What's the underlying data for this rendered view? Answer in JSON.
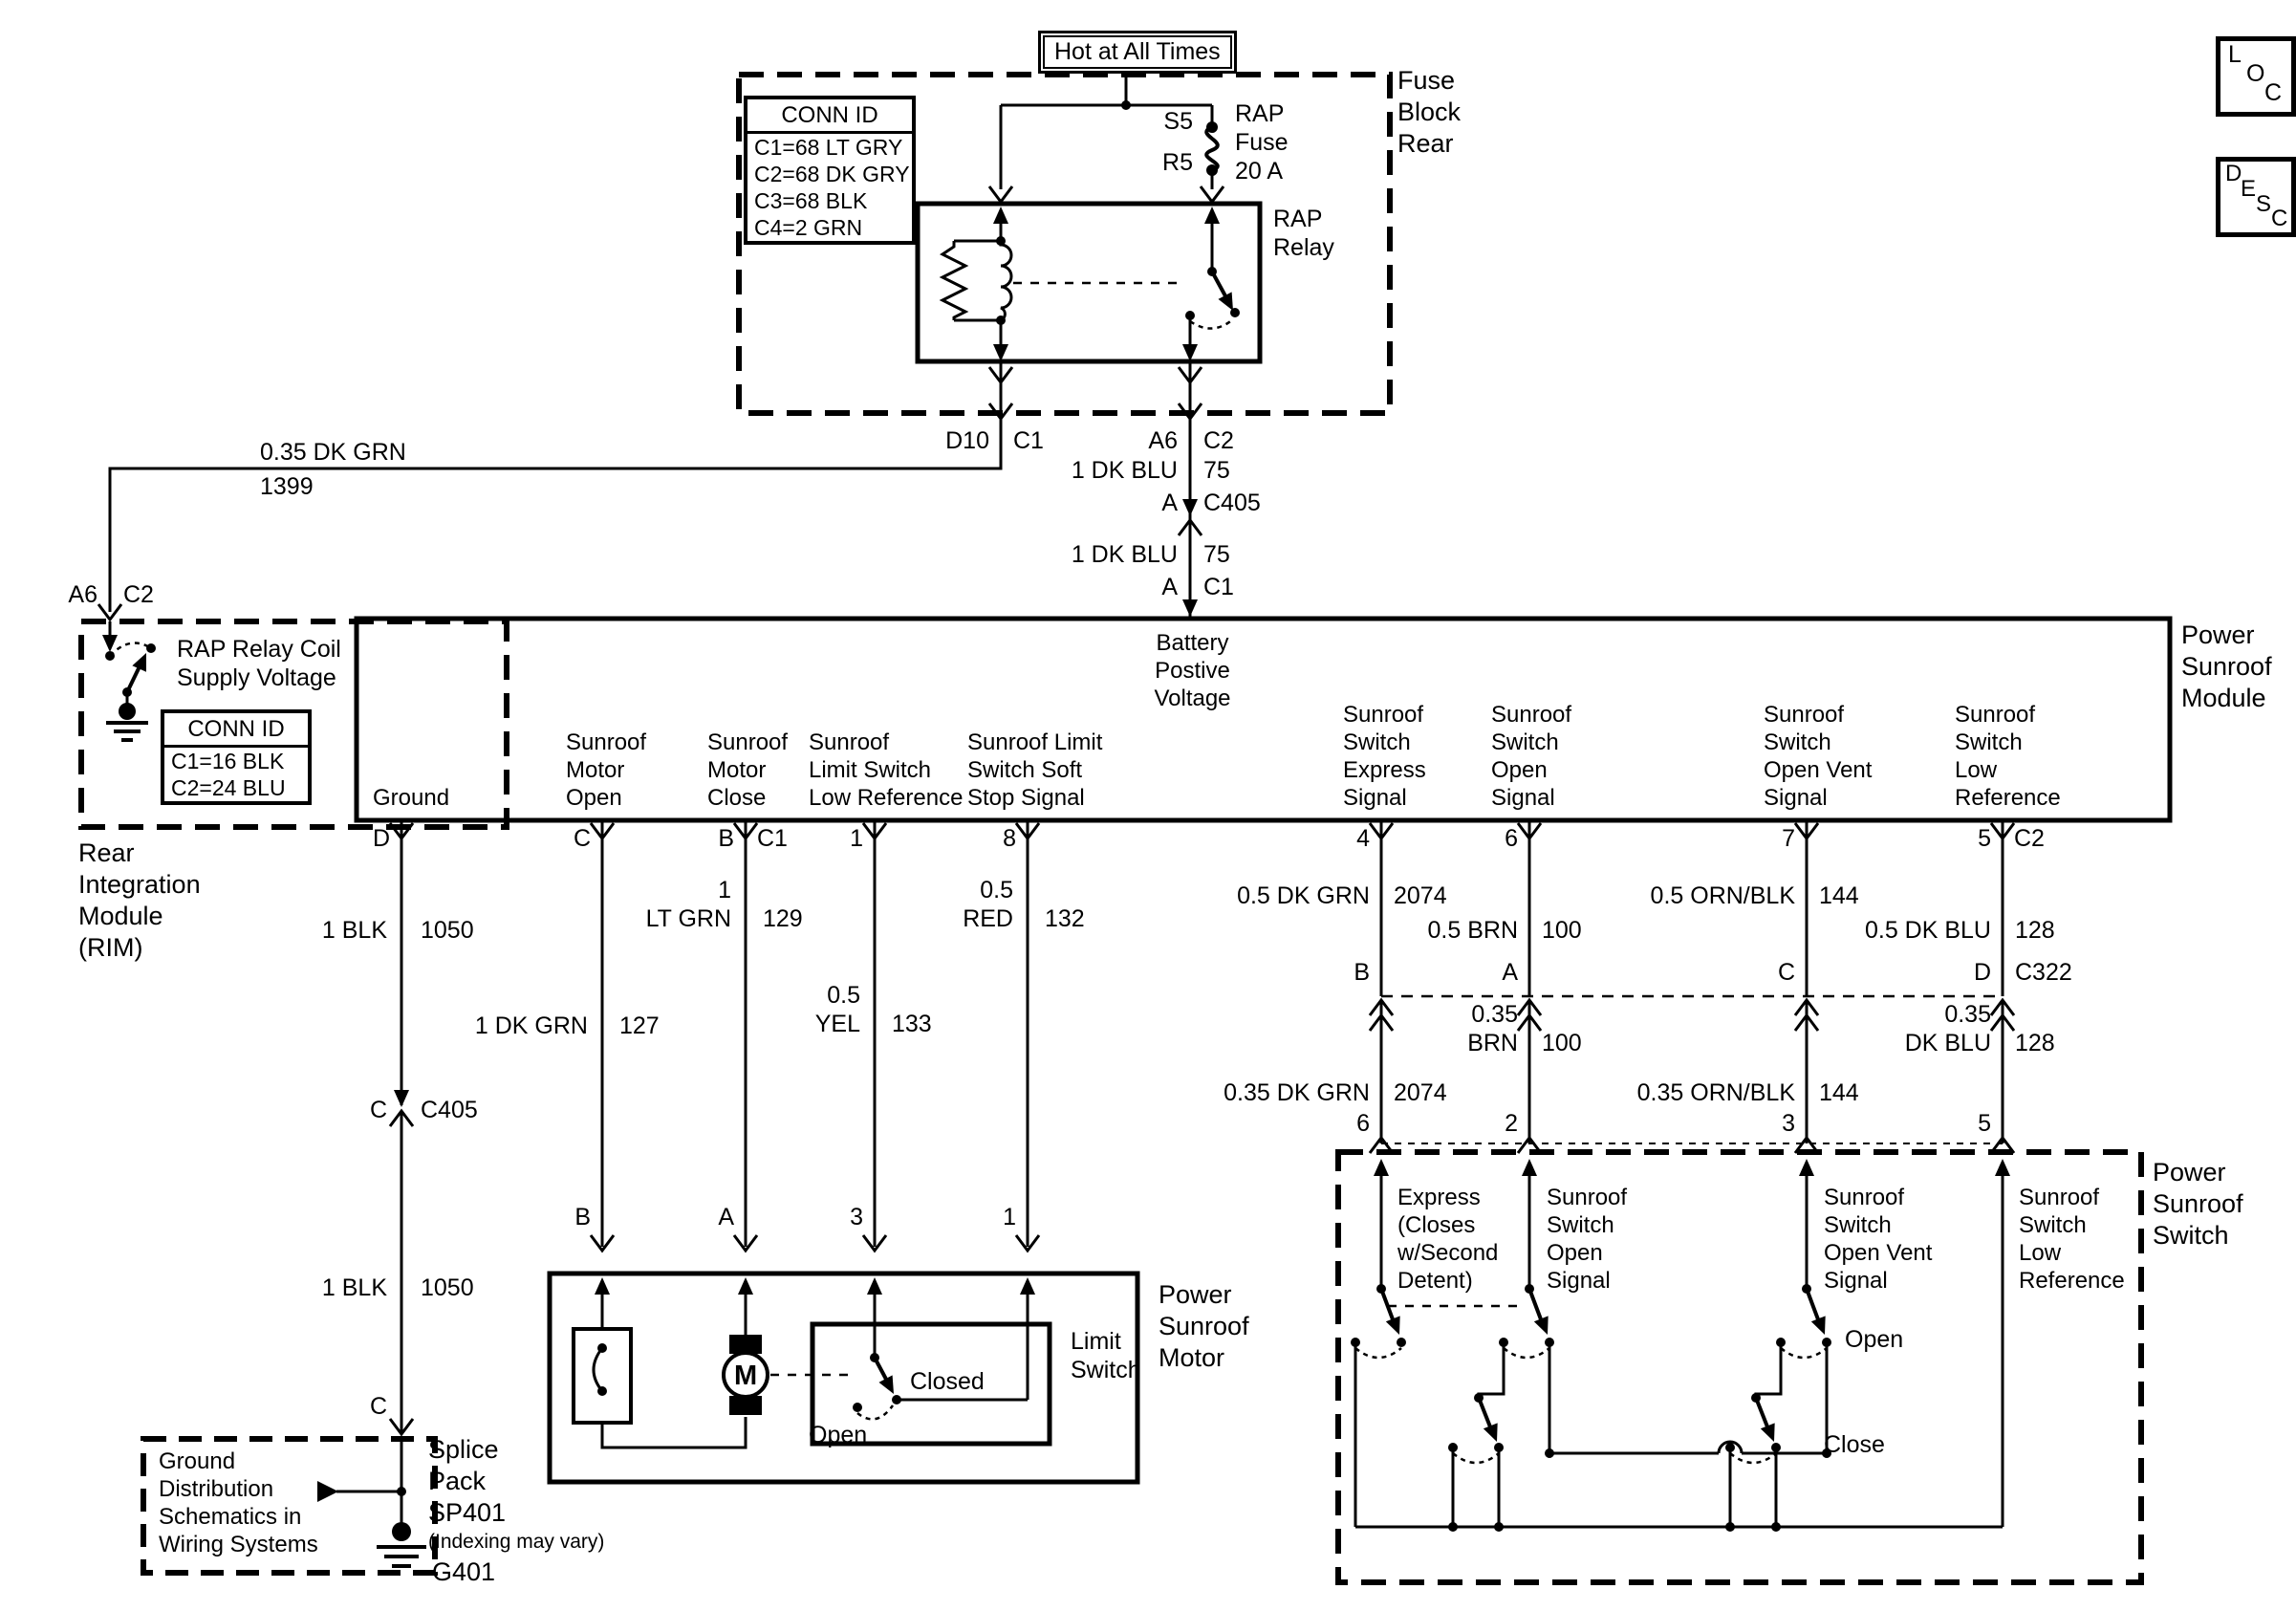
{
  "meta": {
    "ink": "#000000",
    "paper": "#ffffff"
  },
  "corner_buttons": {
    "loc": [
      "L",
      "O",
      "C"
    ],
    "desc": [
      "D",
      "E",
      "S",
      "C"
    ]
  },
  "fuse_block": {
    "hot_label": "Hot at All Times",
    "title": "Fuse\nBlock\nRear",
    "conn_id": {
      "header": "CONN ID",
      "rows": [
        "C1=68 LT GRY",
        "C2=68 DK GRY",
        "C3=68 BLK",
        "C4=2 GRN"
      ]
    },
    "fuse": {
      "top_pin": "S5",
      "bottom_pin": "R5",
      "label": "RAP\nFuse\n20 A"
    },
    "relay_label": "RAP\nRelay",
    "out_left": {
      "pin": "D10",
      "conn": "C1"
    },
    "out_right": {
      "pin": "A6",
      "conn": "C2"
    }
  },
  "battery_feed": {
    "seg1": {
      "label": "1 DK BLU",
      "circuit": "75"
    },
    "c405": {
      "pin": "A",
      "conn": "C405"
    },
    "seg2": {
      "label": "1 DK BLU",
      "circuit": "75"
    },
    "c1": {
      "pin": "A",
      "conn": "C1"
    }
  },
  "rap_wire": {
    "label": "0.35 DK GRN",
    "circuit": "1399"
  },
  "rim": {
    "pin": "A6",
    "conn": "C2",
    "switch_label": "RAP Relay Coil\nSupply Voltage",
    "conn_id": {
      "header": "CONN ID",
      "rows": [
        "C1=16 BLK",
        "C2=24 BLU"
      ]
    },
    "title": "Rear\nIntegration\nModule\n(RIM)"
  },
  "module": {
    "title": "Power\nSunroof\nModule",
    "battery_label": "Battery\nPostive\nVoltage",
    "labels": {
      "ground": "Ground",
      "motor_open": "Sunroof\nMotor\nOpen",
      "motor_close": "Sunroof\nMotor\nClose",
      "limit_low_ref": "Sunroof\nLimit Switch\nLow Reference",
      "soft_stop": "Sunroof Limit\nSwitch Soft\nStop Signal",
      "sw_express": "Sunroof\nSwitch\nExpress\nSignal",
      "sw_open": "Sunroof\nSwitch\nOpen\nSignal",
      "sw_open_vent": "Sunroof\nSwitch\nOpen Vent\nSignal",
      "sw_low_ref": "Sunroof\nSwitch\nLow\nReference"
    },
    "pins": {
      "ground": "D",
      "motor_open": "C",
      "motor_close": "B",
      "motor_close_conn": "C1",
      "limit_low_ref": "1",
      "soft_stop": "8",
      "sw_express": "4",
      "sw_open": "6",
      "sw_open_vent": "7",
      "sw_low_ref": "5",
      "sw_low_ref_conn": "C2"
    }
  },
  "left_wires": {
    "blk_upper": {
      "label": "1 BLK",
      "circuit": "1050"
    },
    "dk_grn": {
      "label": "1 DK GRN",
      "circuit": "127"
    },
    "lt_grn": {
      "label": "1\nLT GRN",
      "circuit": "129"
    },
    "yel": {
      "label": "0.5\nYEL",
      "circuit": "133"
    },
    "red": {
      "label": "0.5\nRED",
      "circuit": "132"
    },
    "c405": {
      "pin": "C",
      "conn": "C405"
    },
    "blk_lower": {
      "label": "1 BLK",
      "circuit": "1050"
    },
    "splice_pin": "C",
    "motor_pins": {
      "close": "B",
      "open": "A",
      "limit": "3",
      "soft": "1"
    }
  },
  "right_wires": {
    "dk_grn_upper": {
      "label": "0.5 DK GRN",
      "circuit": "2074"
    },
    "brn_upper": {
      "label": "0.5 BRN",
      "circuit": "100"
    },
    "orn_blk_upper": {
      "label": "0.5 ORN/BLK",
      "circuit": "144"
    },
    "dk_blu_upper": {
      "label": "0.5 DK BLU",
      "circuit": "128"
    },
    "c322": {
      "pins": {
        "express": "B",
        "open": "A",
        "open_vent": "C",
        "low_ref": "D"
      },
      "conn": "C322"
    },
    "brn_lower": {
      "label": "0.35\nBRN",
      "circuit": "100"
    },
    "dk_blu_lower": {
      "label": "0.35\nDK BLU",
      "circuit": "128"
    },
    "dk_grn_lower": {
      "label": "0.35 DK GRN",
      "circuit": "2074"
    },
    "orn_blk_lower": {
      "label": "0.35 ORN/BLK",
      "circuit": "144"
    },
    "switch_pins": {
      "express": "6",
      "open": "2",
      "open_vent": "3",
      "low_ref": "5"
    }
  },
  "motor": {
    "title": "Power\nSunroof\nMotor",
    "m": "M",
    "limit_label": "Limit\nSwitch",
    "closed": "Closed",
    "open": "Open"
  },
  "ground": {
    "note": "Ground\nDistribution\nSchematics in\nWiring Systems",
    "splice": "Splice\nPack\nSP401",
    "indexing": "(Indexing may vary)",
    "g401": "G401"
  },
  "sunroof_switch": {
    "title": "Power\nSunroof\nSwitch",
    "express": "Express\n(Closes\nw/Second\nDetent)",
    "open_signal": "Sunroof\nSwitch\nOpen\nSignal",
    "open_vent": "Sunroof\nSwitch\nOpen Vent\nSignal",
    "low_ref": "Sunroof\nSwitch\nLow\nReference",
    "open_pos": "Open",
    "close_pos": "Close"
  }
}
